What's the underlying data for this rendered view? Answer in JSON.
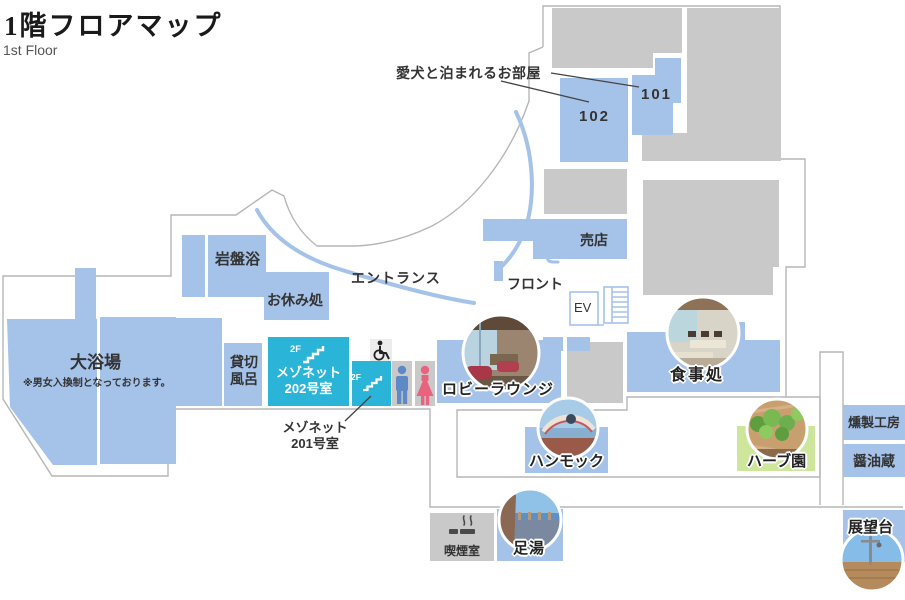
{
  "title": {
    "main": "1階フロアマップ",
    "sub": "1st Floor"
  },
  "labels": {
    "dog_rooms": "愛犬と泊まれるお部屋",
    "room_102": "102",
    "room_101": "101",
    "shop": "売店",
    "front_desk": "フロント",
    "entrance": "エントランス",
    "elevator": "EV",
    "stone_sauna": "岩盤浴",
    "rest_area": "お休み処",
    "large_bath": "大浴場",
    "large_bath_note": "※男女入換制となっております。",
    "private_bath": "貸切風呂",
    "maisonette_202": {
      "lines": [
        "メゾネット",
        "202号室"
      ]
    },
    "maisonette_201": {
      "lines": [
        "メゾネット",
        "201号室"
      ]
    },
    "floor_2f": "2F",
    "lobby_lounge": "ロビーラウンジ",
    "dining": "食事処",
    "hammock": "ハンモック",
    "herb_garden": "ハーブ園",
    "smokehouse": "燻製工房",
    "soy_sauce_storehouse": "醤油蔵",
    "smoking_room": "喫煙室",
    "foot_bath": "足湯",
    "observation_deck": "展望台"
  },
  "colors": {
    "room_blue": "#a5c2e9",
    "facility_gray": "#c9c9c9",
    "maisonette_cyan": "#2ab5d8",
    "herb_green": "#cde69c",
    "outline_gray": "#b6b6b6",
    "male_icon_blue": "#5d8ac6",
    "female_icon_pink": "#e8647e"
  }
}
